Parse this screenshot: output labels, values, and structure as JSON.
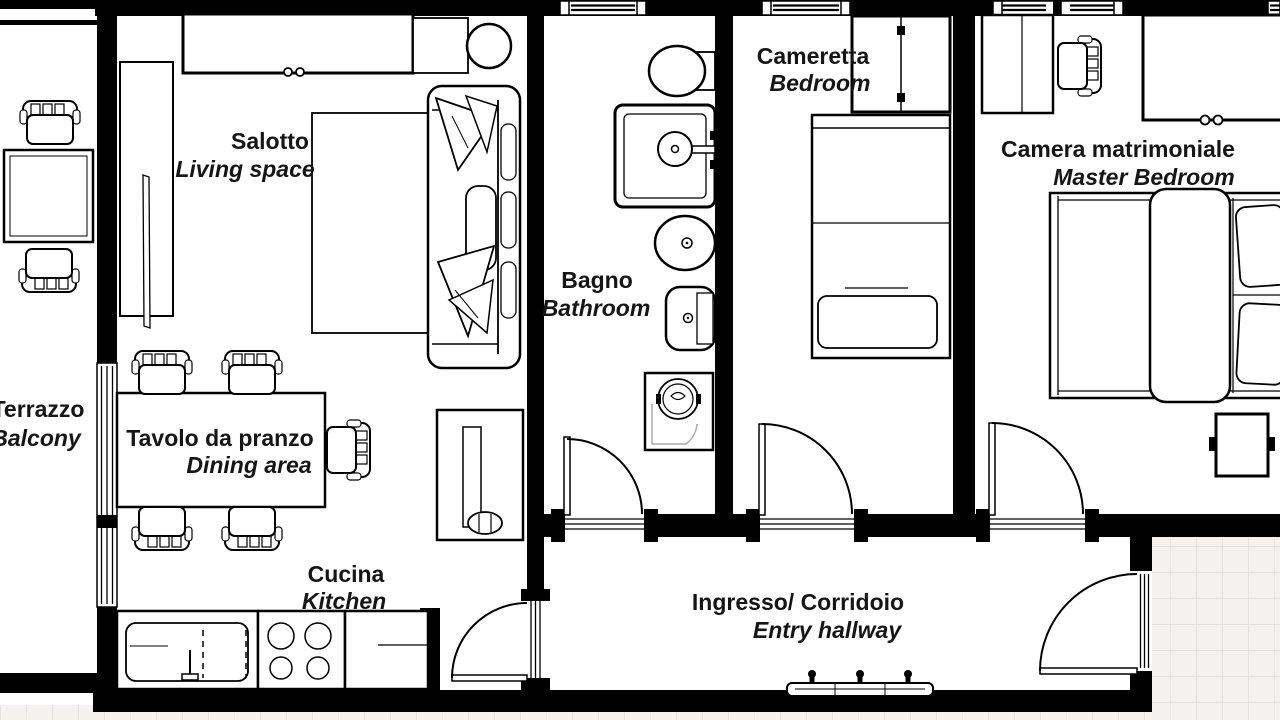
{
  "floorplan": {
    "rooms": [
      {
        "id": "terrazzo",
        "name_it": "Terrazzo",
        "name_en": "Balcony"
      },
      {
        "id": "salotto",
        "name_it": "Salotto",
        "name_en": "Living space"
      },
      {
        "id": "dining",
        "name_it": "Tavolo da pranzo",
        "name_en": "Dining area"
      },
      {
        "id": "cucina",
        "name_it": "Cucina",
        "name_en": "Kitchen"
      },
      {
        "id": "bagno",
        "name_it": "Bagno",
        "name_en": "Bathroom"
      },
      {
        "id": "cameretta",
        "name_it": "Cameretta",
        "name_en": "Bedroom"
      },
      {
        "id": "camera_matrimoniale",
        "name_it": "Camera matrimoniale",
        "name_en": "Master Bedroom"
      },
      {
        "id": "ingresso",
        "name_it": "Ingresso/ Corridoio",
        "name_en": "Entry hallway"
      }
    ],
    "colors": {
      "wall": "#000000",
      "floor": "#ffffff",
      "tile_floor": "#f4f2ee",
      "tile_grid": "#e0ddd6",
      "appliance_detail": "#aaaaaa",
      "text": "#151515"
    }
  }
}
